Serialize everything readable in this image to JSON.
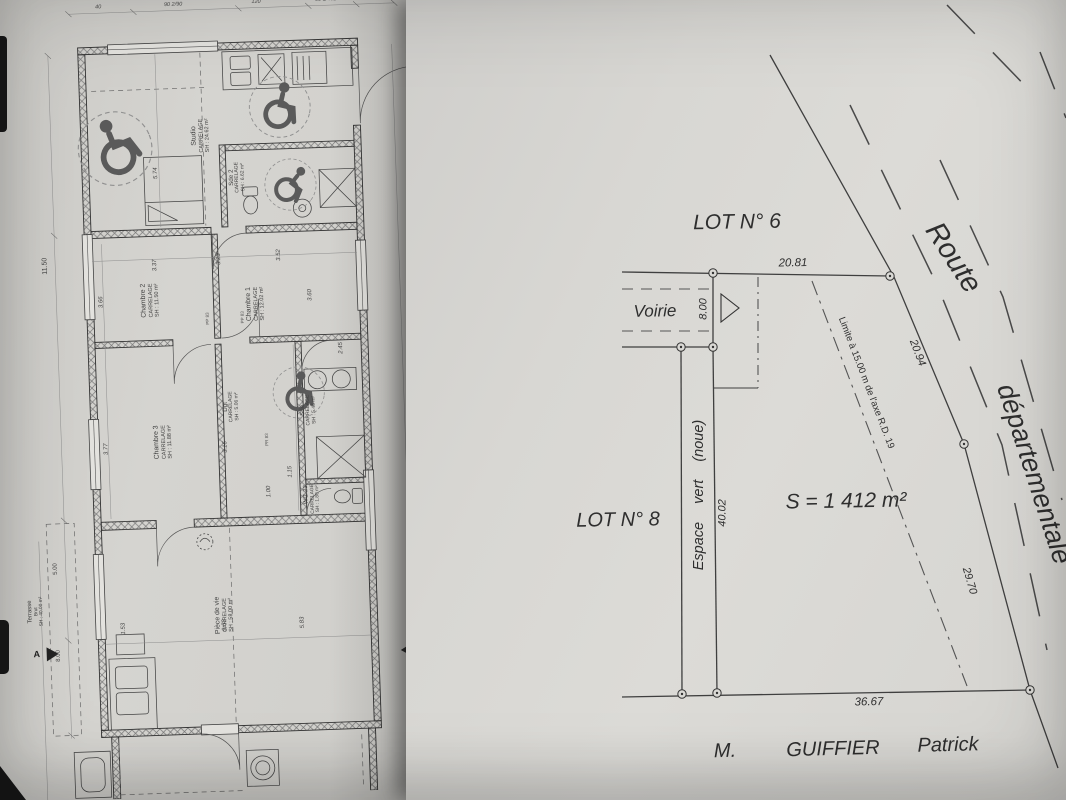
{
  "colors": {
    "paper_left": "#d3d2ce",
    "paper_right": "#dad9d5",
    "ink": "#3a3a3a"
  },
  "floor_plan": {
    "section_marker": "A",
    "rooms": [
      {
        "name": "Studio",
        "finish": "CARRELAGE",
        "area": "SH : 24.62 m²"
      },
      {
        "name": "Sde 2",
        "finish": "CARRELAGE",
        "area": "SH : 6.62 m²"
      },
      {
        "name": "Chambre 1",
        "finish": "CARRELAGE",
        "area": "SH : 12.02 m²"
      },
      {
        "name": "Chambre 2",
        "finish": "CARRELAGE",
        "area": "SH : 11.50 m²"
      },
      {
        "name": "Chambre 3",
        "finish": "CARRELAGE",
        "area": "SH : 11.88 m²"
      },
      {
        "name": "Dgt",
        "finish": "CARRELAGE",
        "area": "SH : 5.06 m²"
      },
      {
        "name": "Sde",
        "finish": "CARRELAGE",
        "area": "SH : 5.46 m²"
      },
      {
        "name": "WC",
        "finish": "CARRELAGE",
        "area": "SH : 1.80 m²"
      },
      {
        "name": "Pièce de vie",
        "finish": "CARRELAGE",
        "area": "SH : 58.00 m²"
      },
      {
        "name": "Terrasse",
        "finish": "Brut",
        "area": "SH : 40.00 m²"
      }
    ],
    "door_labels": [
      "PP 83",
      "PP 83",
      "PR 83"
    ],
    "dims_left": [
      "11.50",
      "5.00",
      "8.00"
    ],
    "dims_top": [
      "40",
      "90 2/90",
      "120",
      "90 1/45B",
      "90"
    ],
    "dims_interior": [
      "5.74",
      "3.37",
      "3.66",
      "3.23",
      "3.52",
      "3.60",
      "3.77",
      "3.16",
      "2.45",
      "1.00",
      "1.15",
      "1.23",
      "1.53",
      "9.53",
      "5.83"
    ]
  },
  "site_plan": {
    "lot6_label": "LOT N° 6",
    "lot8_label": "LOT N° 8",
    "voirie_label": "Voirie",
    "green_strip_label": "Espace vert (noue)",
    "setback_label": "Limite à 15.00 m de l'axe R.D. 19",
    "area_label": "S = 1 412 m²",
    "road_name_1": "Route",
    "road_name_2": "départementale",
    "dimensions": {
      "north": "20.81",
      "voirie_width": "8.00",
      "east_upper": "20.94",
      "east_lower": "29.70",
      "west": "40.02",
      "south": "36.67"
    },
    "owner": {
      "title": "M.",
      "last_name": "GUIFFIER",
      "first_name": "Patrick"
    }
  }
}
